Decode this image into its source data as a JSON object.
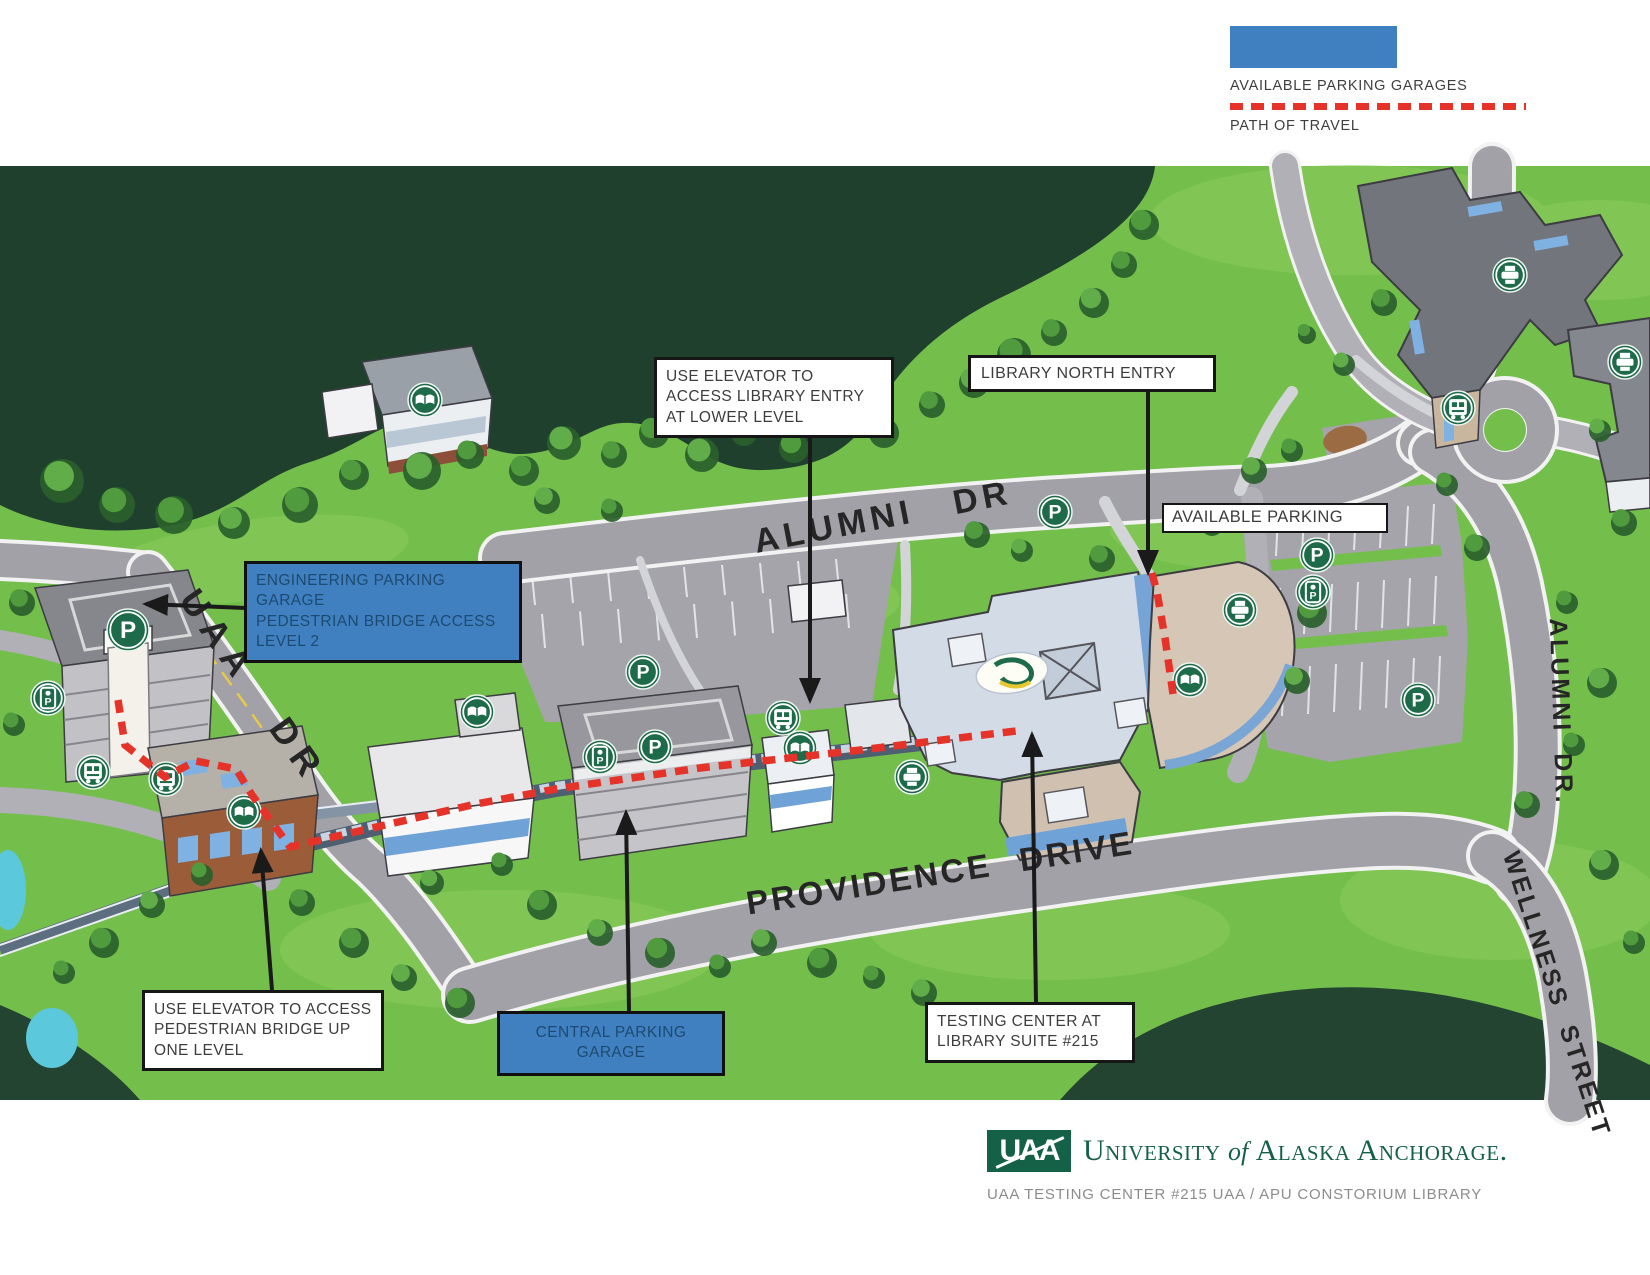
{
  "legend": {
    "garage_swatch_color": "#4080c1",
    "garages_label": "AVAILABLE PARKING GARAGES",
    "path_label": "PATH OF TRAVEL",
    "path_color": "#e5332a"
  },
  "callouts": {
    "use_elevator_library": "USE ELEVATOR TO ACCESS LIBRARY ENTRY AT LOWER LEVEL",
    "library_north_entry": "LIBRARY NORTH ENTRY",
    "available_parking": "AVAILABLE PARKING",
    "engineering_garage": {
      "line1": "ENGINEERING PARKING GARAGE",
      "line2": "PEDESTRIAN BRIDGE ACCESS",
      "line3": "LEVEL 2"
    },
    "use_elevator_pedestrian": "USE ELEVATOR TO ACCESS PEDESTRIAN BRIDGE UP ONE LEVEL",
    "central_garage": "CENTRAL PARKING GARAGE",
    "testing_center": {
      "line1": "TESTING CENTER AT",
      "line2": "LIBRARY SUITE #215"
    }
  },
  "roads": {
    "alumni_dr": "ALUMNI DR",
    "uaa_dr": "UAA DR",
    "providence_drive": "PROVIDENCE DRIVE",
    "alumni_dr_east": "ALUMNI DR.",
    "wellness_street": "WELLNESS STREET"
  },
  "icons": {
    "parking_glyph": "P",
    "icon_green": "#1e6b4a",
    "names": [
      "parking-icon",
      "elevator-icon",
      "bus-icon",
      "library-books-icon",
      "print-copy-icon"
    ]
  },
  "branding": {
    "logo_text": "UAA",
    "university_part1": "University",
    "university_part2": "of",
    "university_part3": "Alaska Anchorage.",
    "caption": "UAA TESTING CENTER #215 UAA / APU CONSTORIUM LIBRARY",
    "brand_green": "#156148"
  }
}
